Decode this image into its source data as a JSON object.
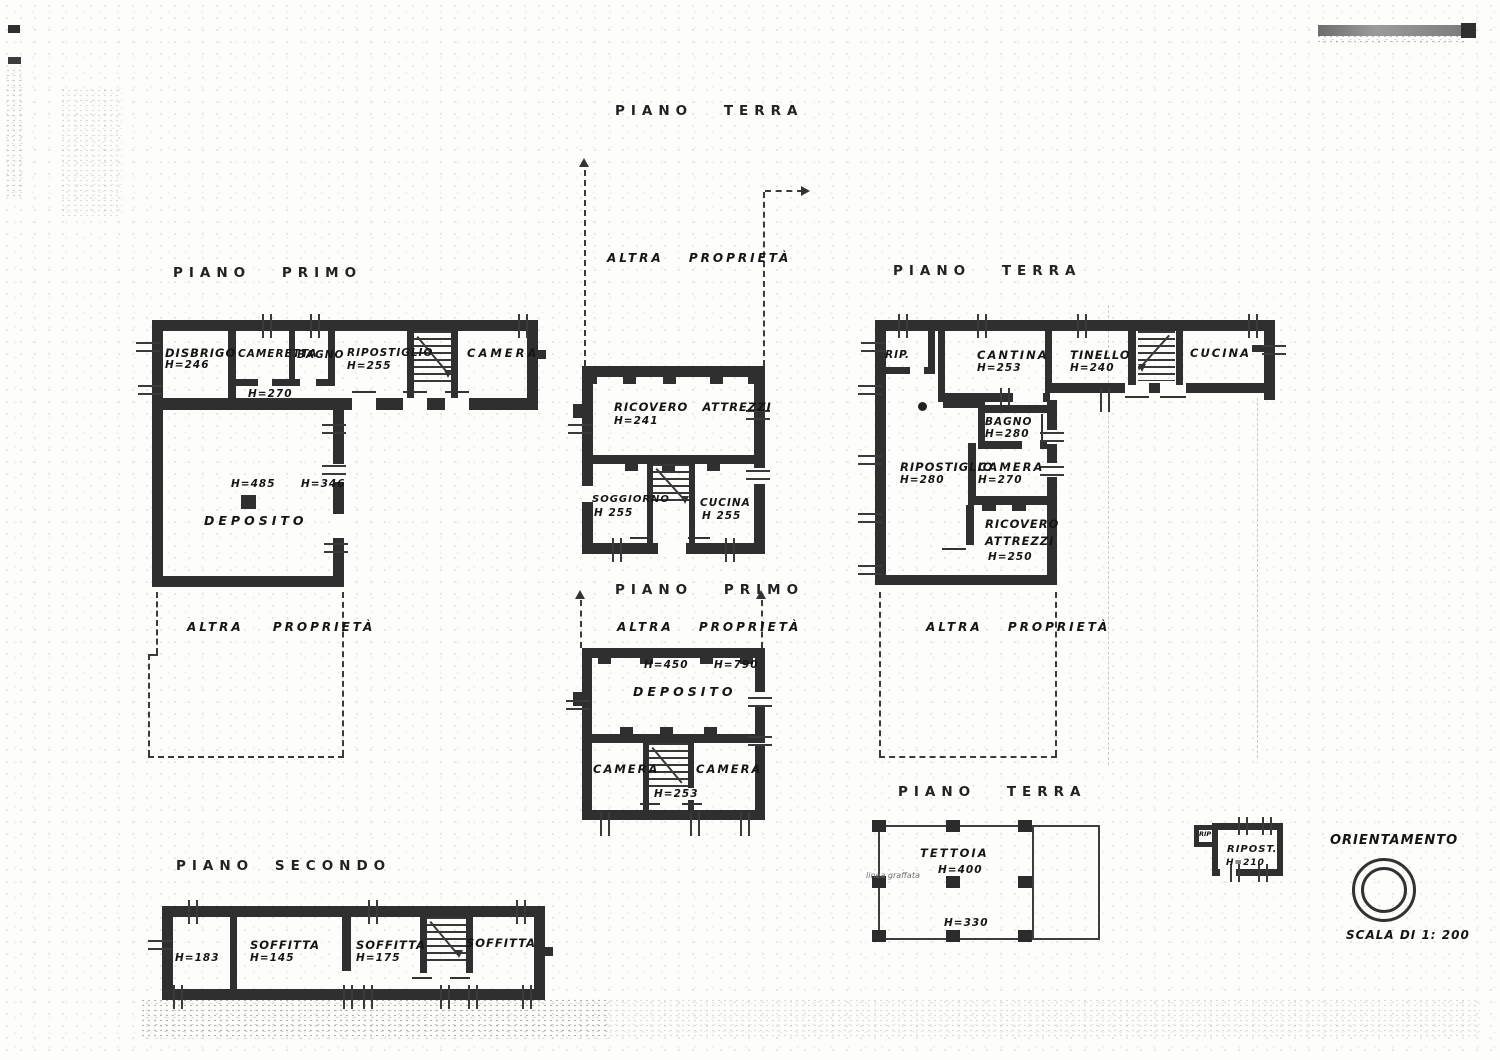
{
  "colors": {
    "ink": "#2f2f2f",
    "paper": "#fdfdfb"
  },
  "titles": {
    "left_first": "PIANO PRIMO",
    "center_ground": "PIANO TERRA",
    "right_ground": "PIANO TERRA",
    "center_first": "PIANO PRIMO",
    "left_second": "PIANO SECONDO",
    "tettoia": "PIANO TERRA"
  },
  "left_first": {
    "disbrigo": "DISBRIGO",
    "disbrigo_h": "H=246",
    "cameretta": "CAMERETTA",
    "cameretta_h": "H=270",
    "bagno": "BAGNO",
    "ripostiglio": "RIPOSTIGLIO",
    "ripostiglio_h": "H=255",
    "camera": "CAMERA",
    "deposito": "DEPOSITO",
    "deposito_h1": "H=485",
    "deposito_h2": "H=346",
    "altra_proprieta": "ALTRA PROPRIETÀ"
  },
  "center_ground": {
    "altra_proprieta": "ALTRA PROPRIETÀ",
    "ricovero": "RICOVERO ATTREZZI",
    "ricovero_h": "H=241",
    "soggiorno": "SOGGIORNO",
    "soggiorno_h": "H 255",
    "cucina": "CUCINA",
    "cucina_h": "H 255"
  },
  "right_ground": {
    "rip": "RIP.",
    "cantina": "CANTINA",
    "cantina_h": "H=253",
    "tinello": "TINELLO",
    "tinello_h": "H=240",
    "cucina": "CUCINA",
    "bagno": "BAGNO",
    "bagno_h": "H=280",
    "ripostiglio": "RIPOSTIGLIO",
    "ripostiglio_h": "H=280",
    "camera": "CAMERA",
    "camera_h": "H=270",
    "ricovero_line1": "RICOVERO",
    "ricovero_line2": "ATTREZZI",
    "ricovero_h": "H=250",
    "altra_proprieta": "ALTRA PROPRIETÀ"
  },
  "center_first": {
    "altra_proprieta": "ALTRA PROPRIETÀ",
    "h_left": "H=450",
    "h_right": "H=790",
    "deposito": "DEPOSITO",
    "camera_left": "CAMERA",
    "camera_right": "CAMERA",
    "stairs_h": "H=253"
  },
  "left_second": {
    "h1": "H=183",
    "soffitta1": "SOFFITTA",
    "soffitta1_h": "H=145",
    "soffitta2": "SOFFITTA",
    "soffitta2_h": "H=175",
    "soffitta3": "SOFFITTA"
  },
  "tettoia": {
    "name": "TETTOIA",
    "h1": "H=400",
    "h2": "H=330",
    "note": "linea graffata"
  },
  "ripost": {
    "rip": "RIP",
    "name": "RIPOST.",
    "h": "H=210"
  },
  "legend": {
    "orientamento": "ORIENTAMENTO",
    "scala": "SCALA DI 1: 200"
  }
}
